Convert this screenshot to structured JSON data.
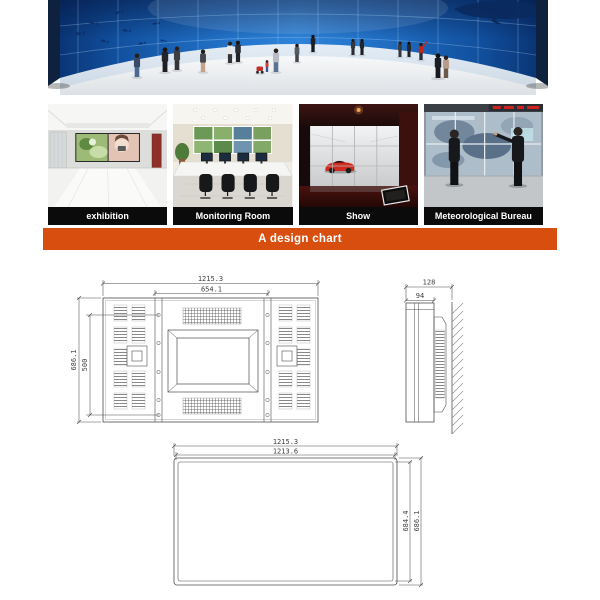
{
  "page": {
    "background": "#ffffff"
  },
  "hero": {
    "scene": "curved-video-wall-underwater-exhibit"
  },
  "gallery": {
    "items": [
      {
        "label": "exhibition"
      },
      {
        "label": "Monitoring Room"
      },
      {
        "label": "Show"
      },
      {
        "label": "Meteorological Bureau"
      }
    ]
  },
  "banner": {
    "label": "A design chart",
    "background": "#d84e0e",
    "text_color": "#ffffff"
  },
  "design_chart": {
    "back_view": {
      "width_outer_mm": "1215.3",
      "width_inner_mm": "654.1",
      "height_outer_mm": "686.1",
      "height_inner_mm": "500"
    },
    "side_view": {
      "depth_outer_mm": "128",
      "depth_body_mm": "94"
    },
    "front_view": {
      "width_outer_mm": "1215.3",
      "width_inner_mm": "1213.6",
      "height_inner_mm": "684.4",
      "height_outer_mm": "686.1"
    }
  }
}
